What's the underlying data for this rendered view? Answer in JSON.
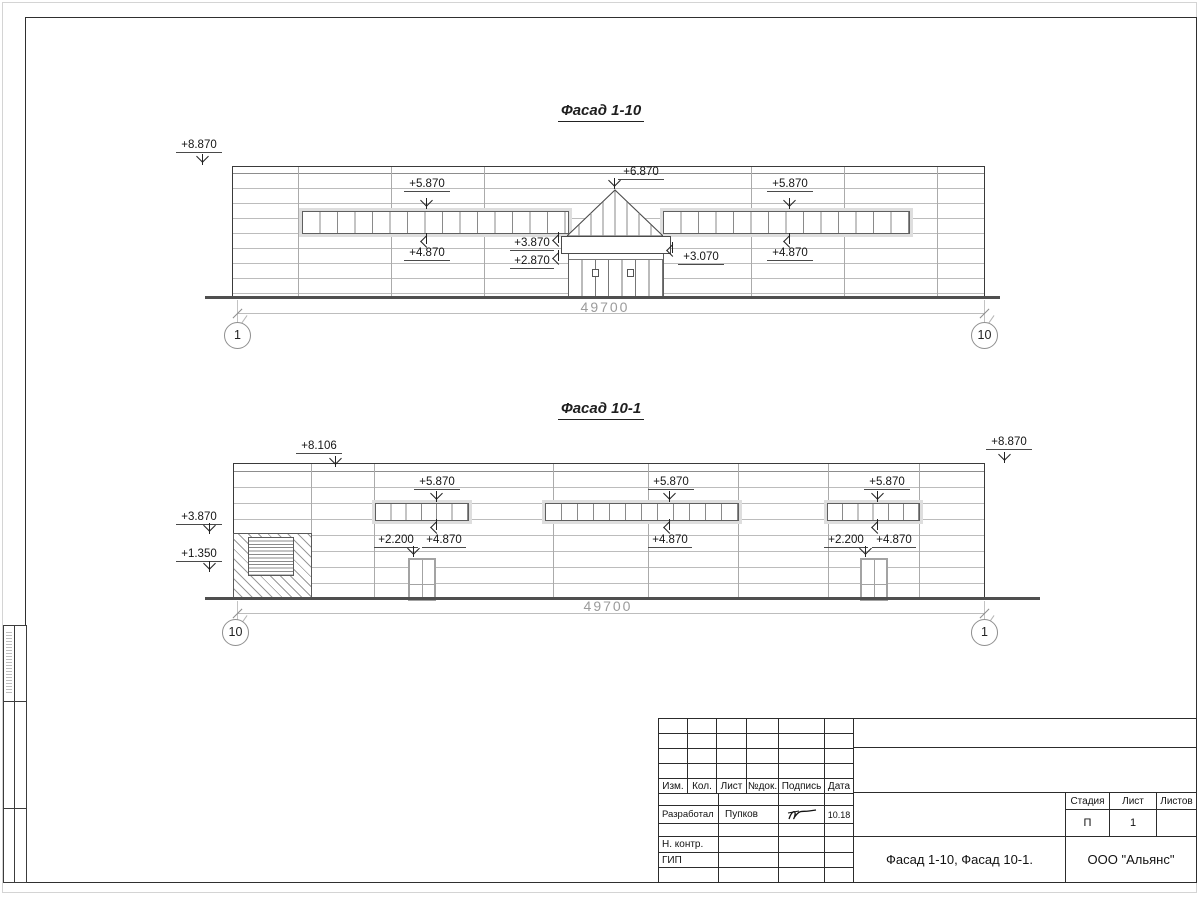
{
  "sheet": {
    "facade1": {
      "title": "Фасад 1-10",
      "dim": "49700",
      "axis_left": "1",
      "axis_right": "10",
      "marks": {
        "parapet": "+8.870",
        "strip_l_top": "+5.870",
        "strip_l_bot": "+4.870",
        "canopy_peak": "+6.870",
        "canopy_top": "+3.870",
        "canopy_bot": "+2.870",
        "canopy_right": "+3.070",
        "strip_r_top": "+5.870",
        "strip_r_bot": "+4.870"
      }
    },
    "facade2": {
      "title": "Фасад 10-1",
      "dim": "49700",
      "axis_left": "10",
      "axis_right": "1",
      "marks": {
        "parapet_left": "+8.106",
        "parapet_right": "+8.870",
        "gate_top": "+3.870",
        "gate_bot": "+1.350",
        "strip1_top": "+5.870",
        "strip1_bot": "+4.870",
        "door1": "+2.200",
        "strip2_top": "+5.870",
        "strip2_bot": "+4.870",
        "strip3_top": "+5.870",
        "strip3_bot": "+4.870",
        "door2": "+2.200"
      }
    },
    "titleblock": {
      "cols": {
        "izm": "Изм.",
        "kol": "Кол.",
        "list": "Лист",
        "doc": "№док.",
        "sign": "Подпись",
        "date": "Дата"
      },
      "razrab_label": "Разработал",
      "razrab_name": "Пупков",
      "razrab_date": "10.18",
      "nkontr_label": "Н. контр.",
      "gip_label": "ГИП",
      "stage_label": "Стадия",
      "sheet_label": "Лист",
      "sheets_label": "Листов",
      "stage_value": "П",
      "sheet_value": "1",
      "doc_title": "Фасад 1-10, Фасад 10-1.",
      "company": "ООО \"Альянс\""
    }
  }
}
